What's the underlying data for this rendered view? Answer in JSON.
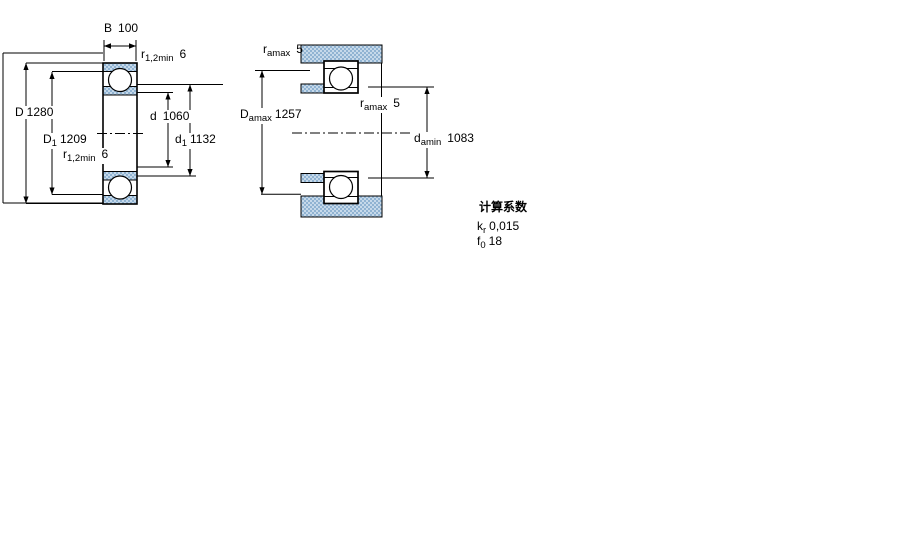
{
  "left_figure": {
    "width_dim": {
      "sym": "B",
      "value": "100"
    },
    "outer_dia": {
      "sym": "D",
      "value": "1280"
    },
    "outer_shoulder_dia": {
      "sym": "D",
      "sub": "1",
      "value": "1209"
    },
    "fillet_top": {
      "sym": "r",
      "sub": "1,2min",
      "value": "6"
    },
    "fillet_bottom": {
      "sym": "r",
      "sub": "1,2min",
      "value": "6"
    },
    "bore_dia": {
      "sym": "d",
      "value": "1060"
    },
    "inner_shoulder_dia": {
      "sym": "d",
      "sub": "1",
      "value": "1132"
    }
  },
  "right_figure": {
    "fillet_housing": {
      "sym": "r",
      "sub": "amax",
      "value": "5"
    },
    "housing_abutment_dia": {
      "sym": "D",
      "sub": "amax",
      "value": "1257"
    },
    "fillet_shaft": {
      "sym": "r",
      "sub": "amax",
      "value": "5"
    },
    "shaft_abutment_dia": {
      "sym": "d",
      "sub": "amin",
      "value": "1083"
    }
  },
  "calculation_factors": {
    "title": "计算系数",
    "rows": [
      {
        "sym": "k",
        "sub": "r",
        "value": "0,015"
      },
      {
        "sym": "f",
        "sub": "0",
        "value": "18"
      }
    ]
  },
  "colors": {
    "line": "#000000",
    "hatch_base": "#c6d9ea",
    "hatch_dot": "#90b3d2",
    "background": "#ffffff"
  }
}
